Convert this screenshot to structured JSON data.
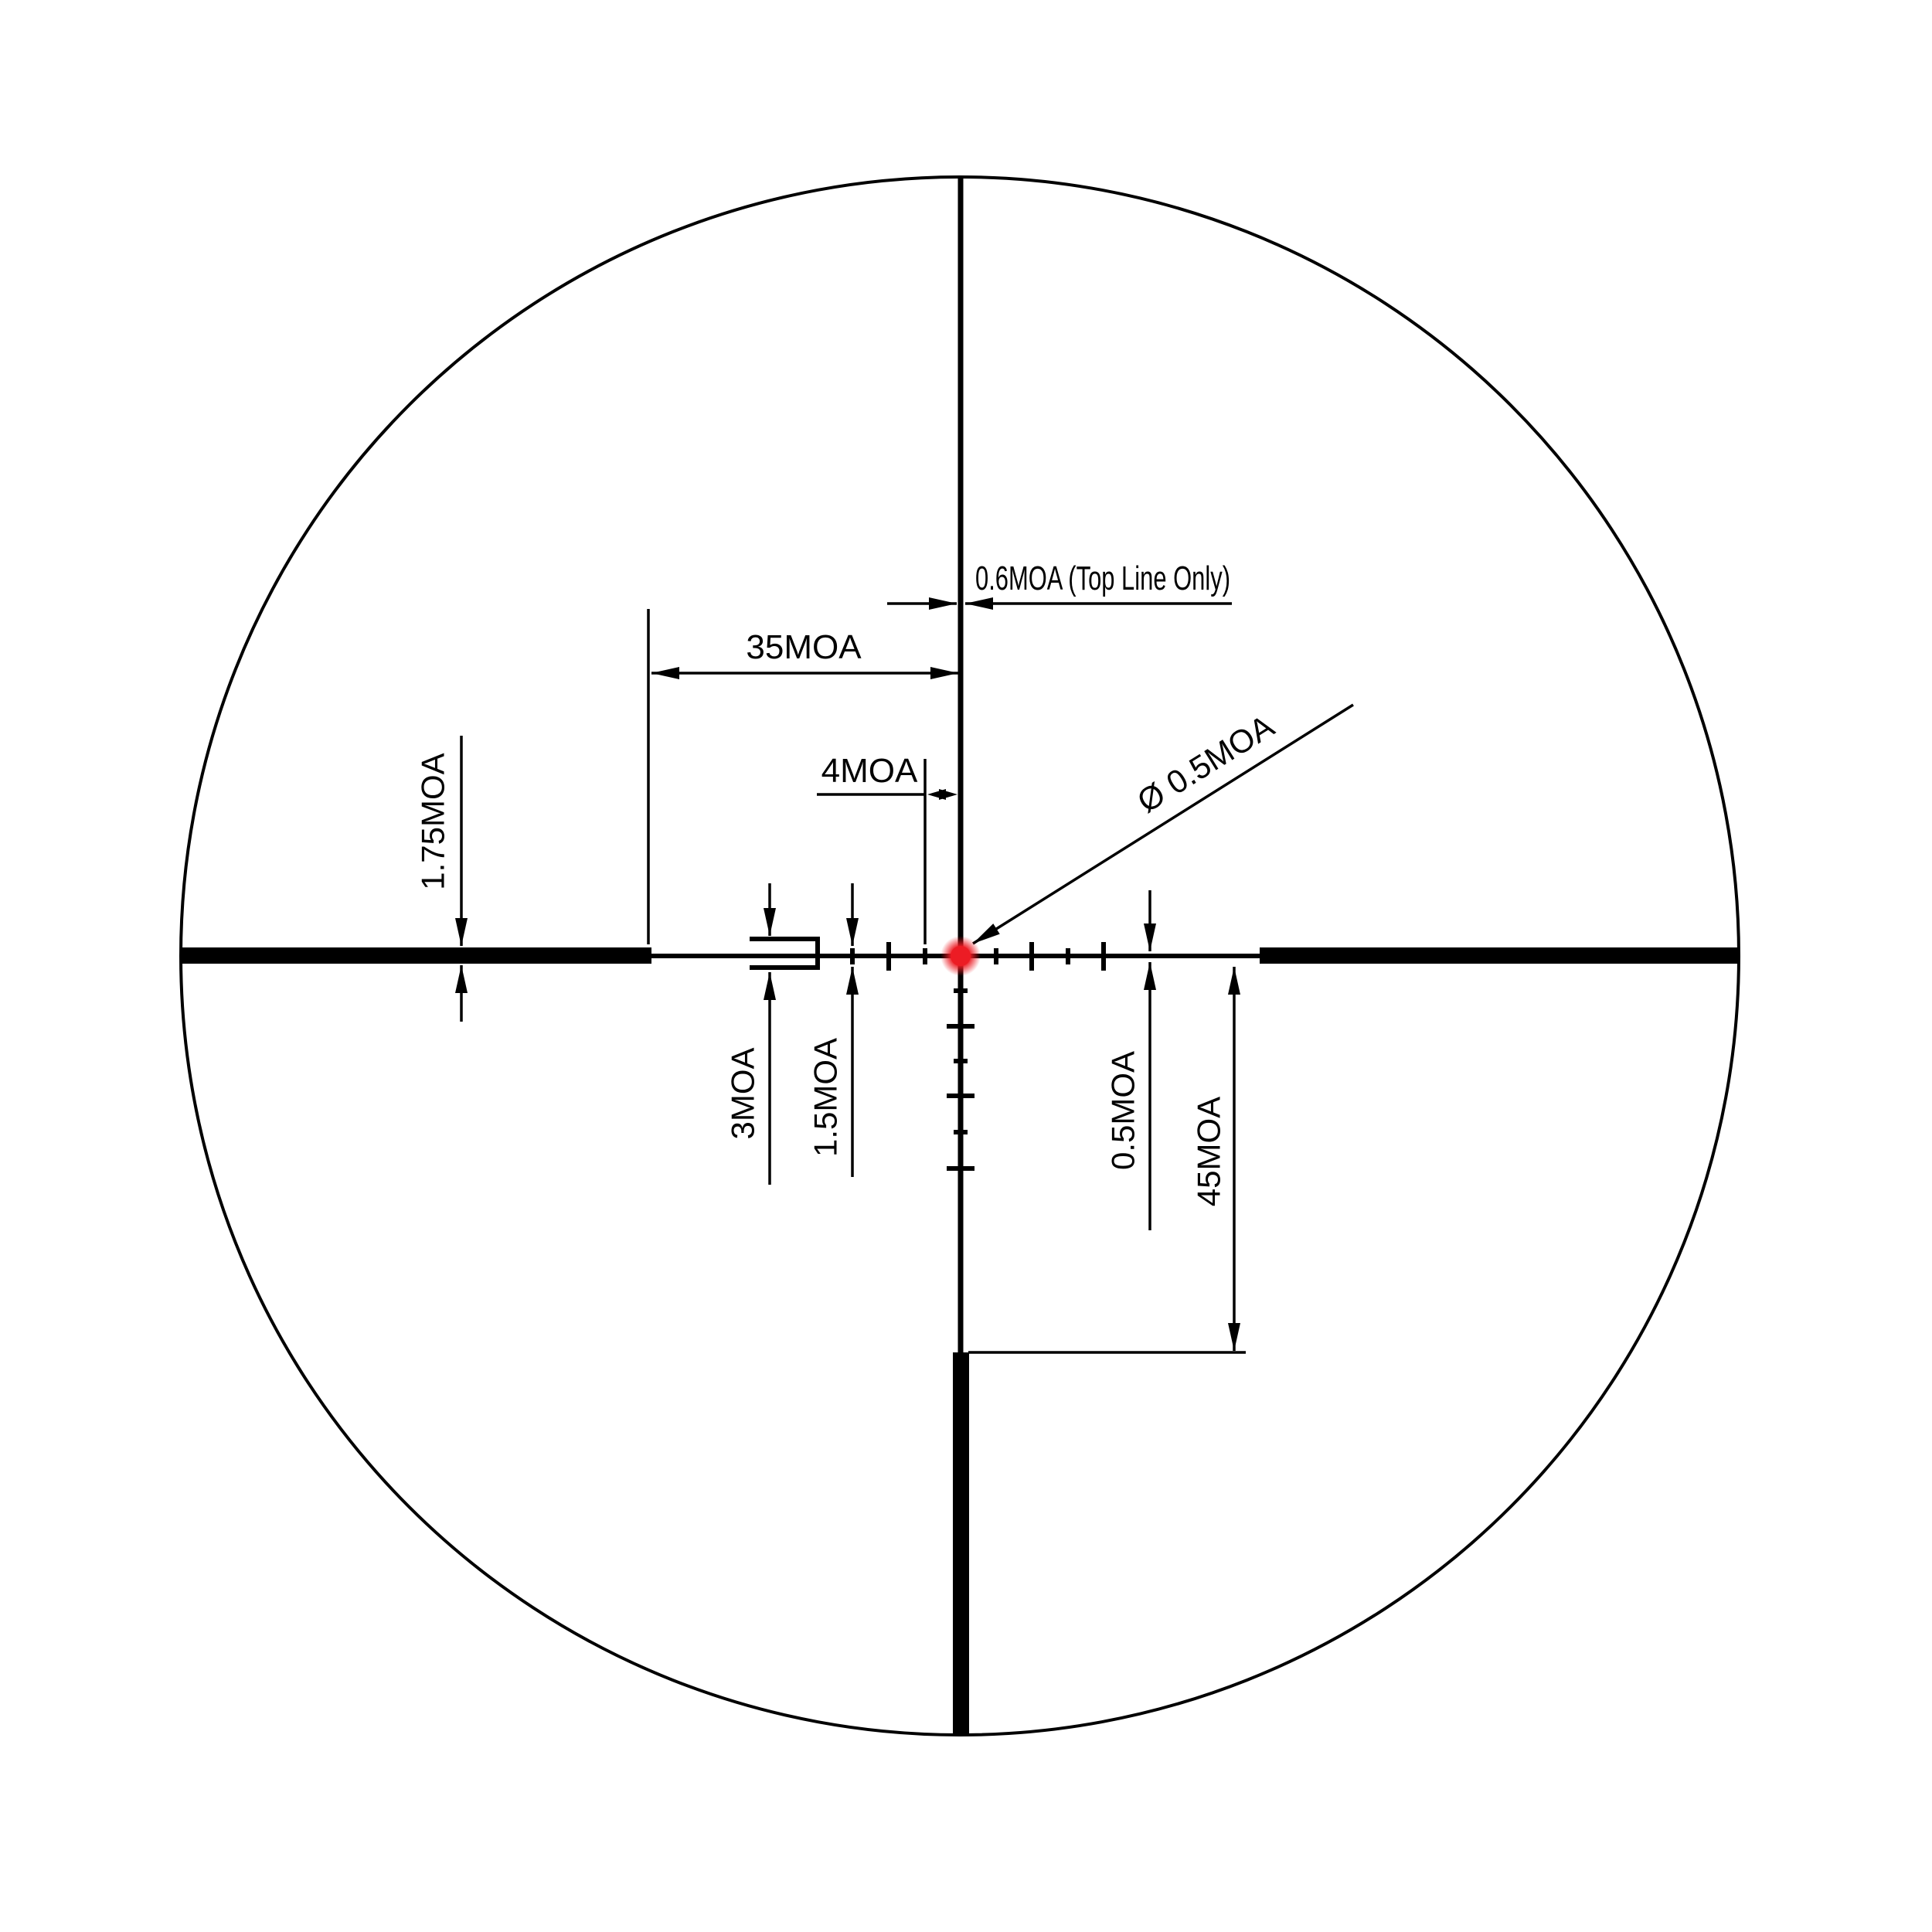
{
  "page": {
    "background": "#ffffff"
  },
  "diagram": {
    "name": "riflescope-reticle-subtension-diagram",
    "type": "reticle-dimension-drawing",
    "colors": {
      "line": "#000000",
      "center_dot": "#ec1c24"
    },
    "labels": {
      "top_line_width": "0.6MOA (Top Line Only)",
      "bar_to_center": "35MOA",
      "tick_spacing": "4MOA",
      "bar_thickness": "1.75MOA",
      "fork_height": "3MOA",
      "tick_height": "1.5MOA",
      "line_thickness": "0.5MOA",
      "bottom_post_distance": "45MOA",
      "center_dot_diameter": "Ø 0.5MOA"
    }
  }
}
